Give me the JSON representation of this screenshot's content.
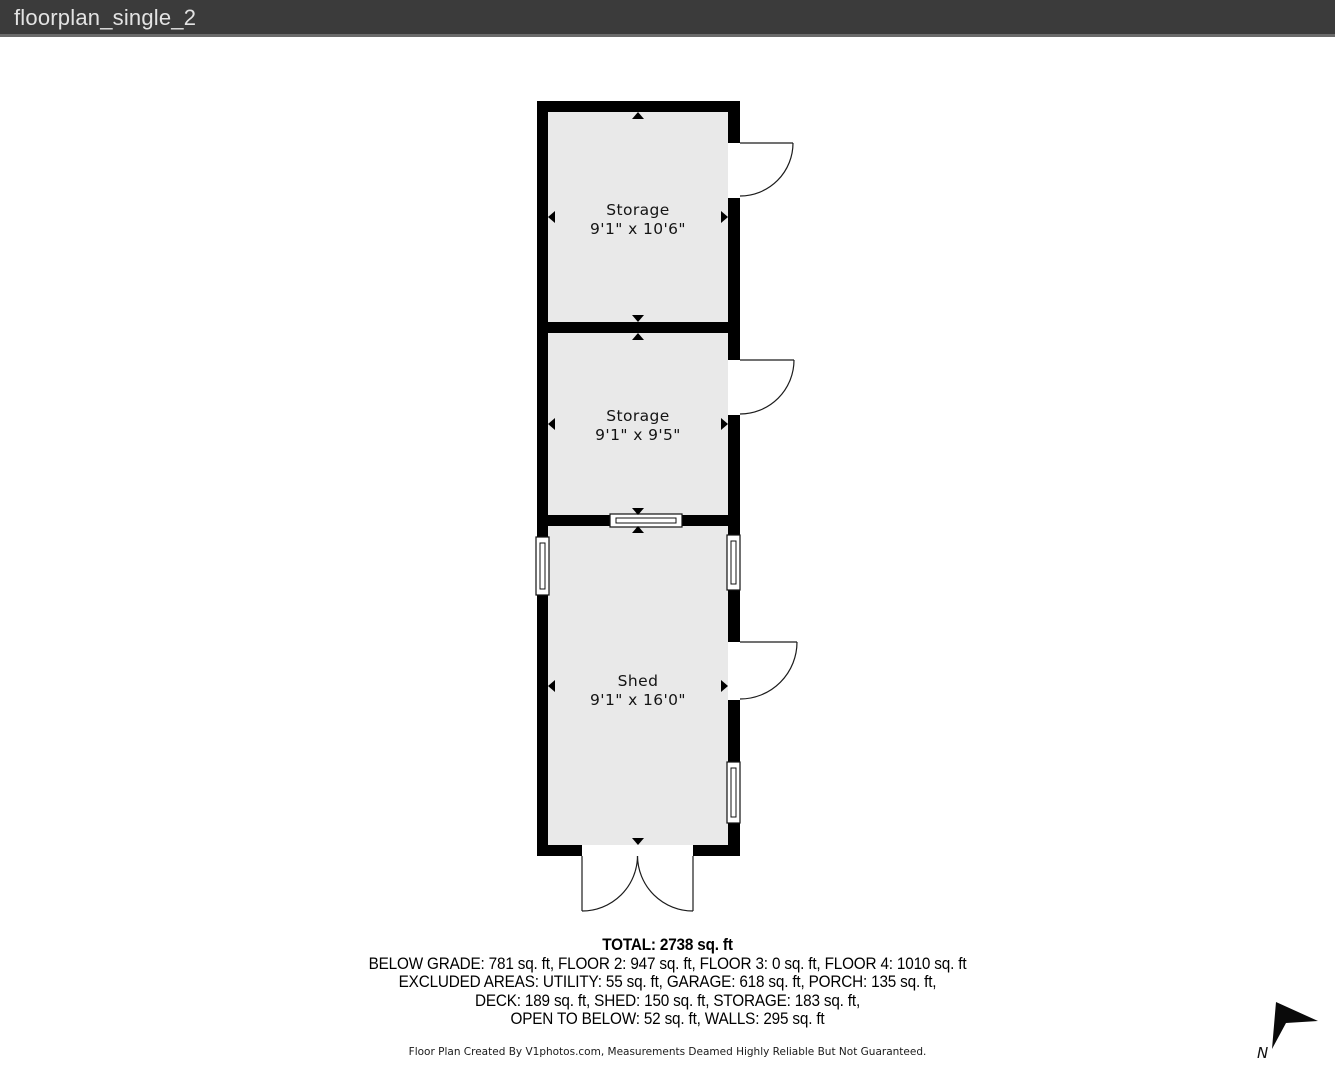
{
  "window": {
    "title": "floorplan_single_2"
  },
  "floorplan": {
    "rooms": [
      {
        "name": "Storage",
        "dimensions": "9'1\" x 10'6\""
      },
      {
        "name": "Storage",
        "dimensions": "9'1\" x 9'5\""
      },
      {
        "name": "Shed",
        "dimensions": "9'1\" x 16'0\""
      }
    ],
    "features": [
      "door",
      "door",
      "door",
      "double-door",
      "window-left",
      "window-right-top",
      "window-right-bottom",
      "pass-through-window"
    ],
    "compass_label": "N"
  },
  "summary": {
    "total": "TOTAL: 2738 sq. ft",
    "lines": [
      "BELOW GRADE: 781 sq. ft, FLOOR 2: 947 sq. ft, FLOOR 3: 0 sq. ft, FLOOR 4: 1010 sq. ft",
      "EXCLUDED AREAS: UTILITY: 55 sq. ft, GARAGE: 618 sq. ft, PORCH: 135 sq. ft,",
      "DECK: 189 sq. ft, SHED: 150 sq. ft, STORAGE: 183 sq. ft,",
      "OPEN TO BELOW: 52 sq. ft, WALLS: 295 sq. ft"
    ]
  },
  "footer": {
    "disclaimer": "Floor Plan Created By V1photos.com, Measurements Deamed Highly Reliable But Not Guaranteed."
  },
  "colors": {
    "wall": "#000000",
    "floor": "#e9e9e9",
    "header_bg": "#3b3b3b",
    "header_text": "#e3e3e3",
    "line": "#1c1c1c"
  }
}
